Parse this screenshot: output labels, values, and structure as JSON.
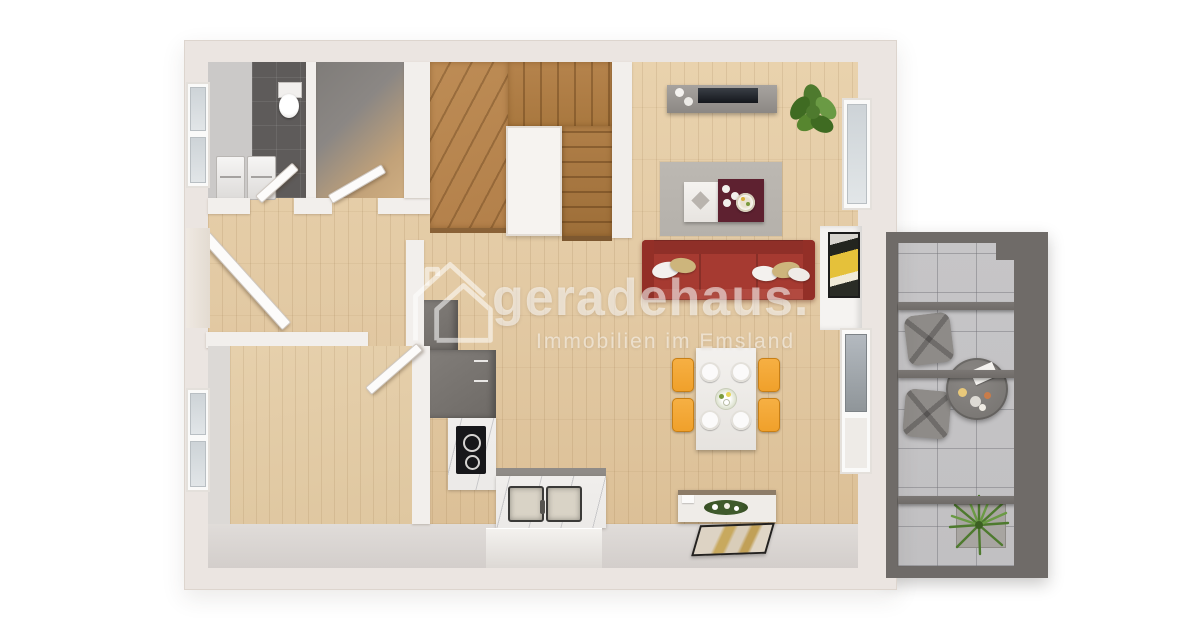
{
  "watermark": {
    "logo_icon": "house-outline-icon",
    "brand": "geradehaus.",
    "tagline": "Immobilien im Emsland"
  },
  "palette": {
    "background": "#ffffff",
    "outer_wall": "#ebe5e1",
    "inner_wall": "#f2efec",
    "wood_floor": "#e2c9a3",
    "room_floor": "#dfc7a0",
    "stair_wood": "#b3804a",
    "bathroom_tile": "#5e5b5a",
    "storage_gray": "#8b8784",
    "kitchen_unit": "#6e6a66",
    "marble": "#eceae8",
    "cooktop_black": "#17171a",
    "sofa_red": "#a63a31",
    "pillow_gold": "#cdb57c",
    "rug_gray": "#b5b1ab",
    "coffee_table_maroon": "#5e2130",
    "dining_chair_orange": "#f0a02a",
    "terrace_frame": "#6f6b68",
    "terrace_tile": "#c1c0c2",
    "terrace_furniture": "#8e8b88",
    "plant_green": "#4e7a2e",
    "glass_blue": "#cdd3d7",
    "watermark_white": "rgba(255,255,255,0.55)"
  }
}
